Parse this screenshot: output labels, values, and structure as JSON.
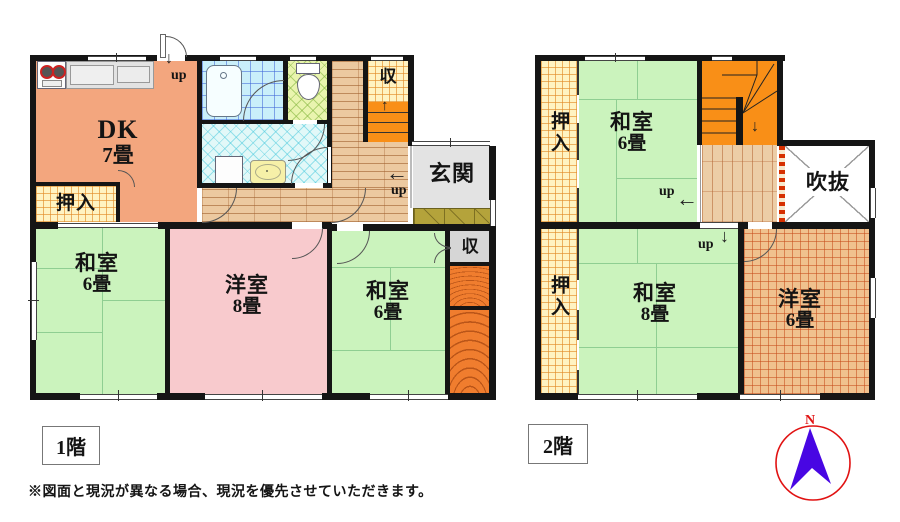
{
  "floorplan": {
    "floor1": {
      "label": "1階",
      "rooms": {
        "dk": {
          "name": "DK",
          "size": "7畳"
        },
        "oshiire": {
          "name": "押入"
        },
        "washitsu_left": {
          "name": "和室",
          "size": "6畳"
        },
        "youshitsu": {
          "name": "洋室",
          "size": "8畳"
        },
        "washitsu_right": {
          "name": "和室",
          "size": "6畳"
        },
        "genkan": {
          "name": "玄関"
        },
        "storage_top": {
          "name": "収"
        },
        "storage_side": {
          "name": "収"
        }
      },
      "annotations": {
        "up_back_door": "up",
        "up_entry": "up"
      }
    },
    "floor2": {
      "label": "2階",
      "rooms": {
        "oshiire_top": {
          "name": "押入"
        },
        "oshiire_bottom": {
          "name": "押入"
        },
        "washitsu_6": {
          "name": "和室",
          "size": "6畳"
        },
        "washitsu_8": {
          "name": "和室",
          "size": "8畳"
        },
        "youshitsu_6": {
          "name": "洋室",
          "size": "6畳"
        },
        "fukinuke": {
          "name": "吹抜"
        }
      },
      "annotations": {
        "up_hall": "up",
        "up_down": "up"
      }
    },
    "icons": {
      "up_arrow": "↑",
      "down_arrow": "↓",
      "left_arrow": "←"
    },
    "footer": {
      "disclaimer": "※図面と現況が異なる場合、現況を優先させていただきます。"
    },
    "compass": {
      "north": "N"
    },
    "colors": {
      "tatami_green": "#cbf3bd",
      "dk_orange": "#f3a67e",
      "western_pink": "#f8cacd",
      "stair_orange": "#f98f17",
      "wall_black": "#151515",
      "compass_red": "#e11212",
      "compass_arrow_blue": "#4806e3"
    }
  }
}
